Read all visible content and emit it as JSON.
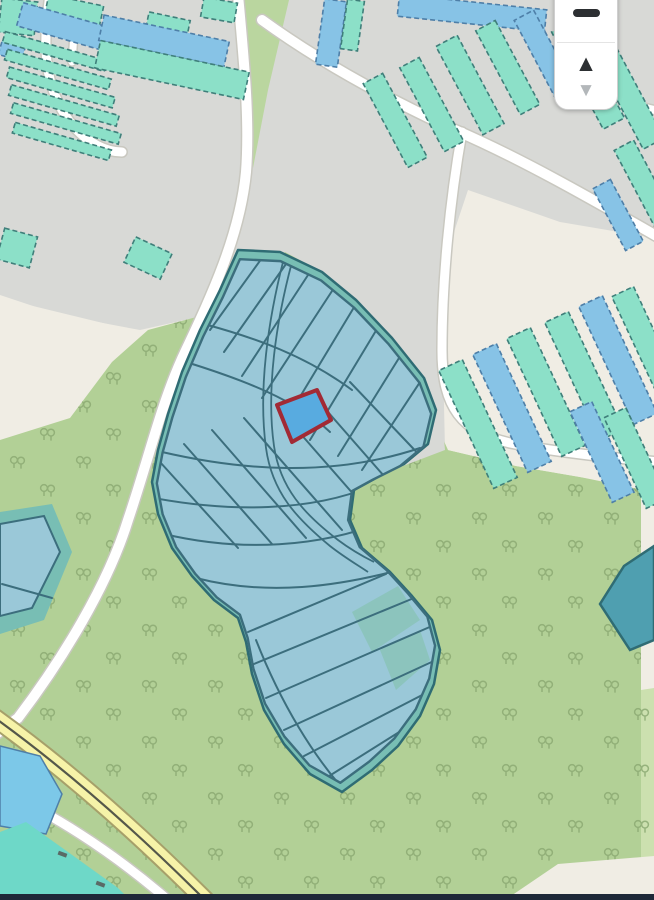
{
  "widget": {
    "zoom_out_icon": "minus-icon",
    "up_glyph": "▲",
    "down_glyph": "▼"
  },
  "map": {
    "selected_parcel": "highlighted cadastral parcel",
    "tree_symbol": "orchard-tree-icon"
  },
  "colors": {
    "base": "#f0ede4",
    "industrial": "#d8d9d6",
    "orchard": "#b2d096",
    "orchard_light": "#cce0af",
    "grass": "#bad69f",
    "tree": "#8caa73",
    "road_fill": "#ffffff",
    "road_casing": "#c9c8c0",
    "road_yellow": "#f6f3a8",
    "road_yellow_casing": "#a6a06a",
    "road_yellow_line": "#55584a",
    "building_teal": "#8ce0c8",
    "building_teal_border": "#3f7f7a",
    "building_blue": "#87c3e6",
    "building_blue_border": "#4e7fa8",
    "zone_buffer": "#78beb4",
    "zone_buffer_edge": "#2f6c74",
    "parcel_fill": "#9ac8d8",
    "parcel_line": "#3c6e7d",
    "parcel_teal": "#8cc4bd",
    "right_parcel": "#4f9fb0",
    "selected_fill": "#58abe0",
    "selected_outline": "#a22a35",
    "water_teal": "#6ed8c8",
    "pond_blue": "#7cc8e8",
    "bottom_bar": "#1e2838",
    "widget_bg": "#ffffff",
    "widget_border": "#cfcfcf",
    "widget_divider": "#e4e4e4",
    "icon_dark": "#2c2f32",
    "icon_gray": "#b3b7ba"
  }
}
